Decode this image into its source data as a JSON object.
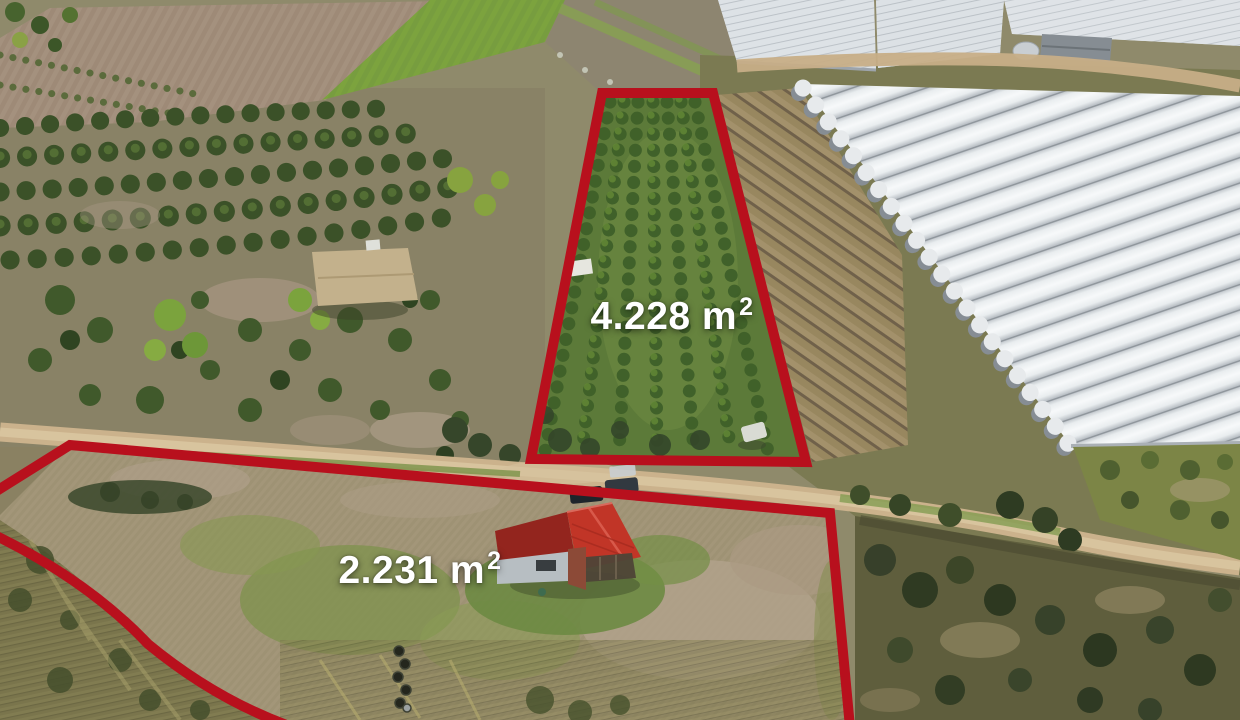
{
  "annotations": {
    "outline_color": "#b8101d",
    "label_color": "#ffffff",
    "plots": [
      {
        "name": "orchard-parcel",
        "area_text": "4.228 m",
        "area_exponent": "2"
      },
      {
        "name": "house-parcel",
        "area_text": "2.231 m",
        "area_exponent": "2"
      }
    ]
  },
  "scene_features": [
    "plowed-field",
    "green-field",
    "olive-grove",
    "palm-trees",
    "citrus-orchard-rows",
    "bare-orchard-rows",
    "plastic-greenhouses",
    "farm-building",
    "dirt-road",
    "red-roof-house",
    "parked-cars",
    "stacked-tires",
    "dry-meadow",
    "tall-grass"
  ]
}
